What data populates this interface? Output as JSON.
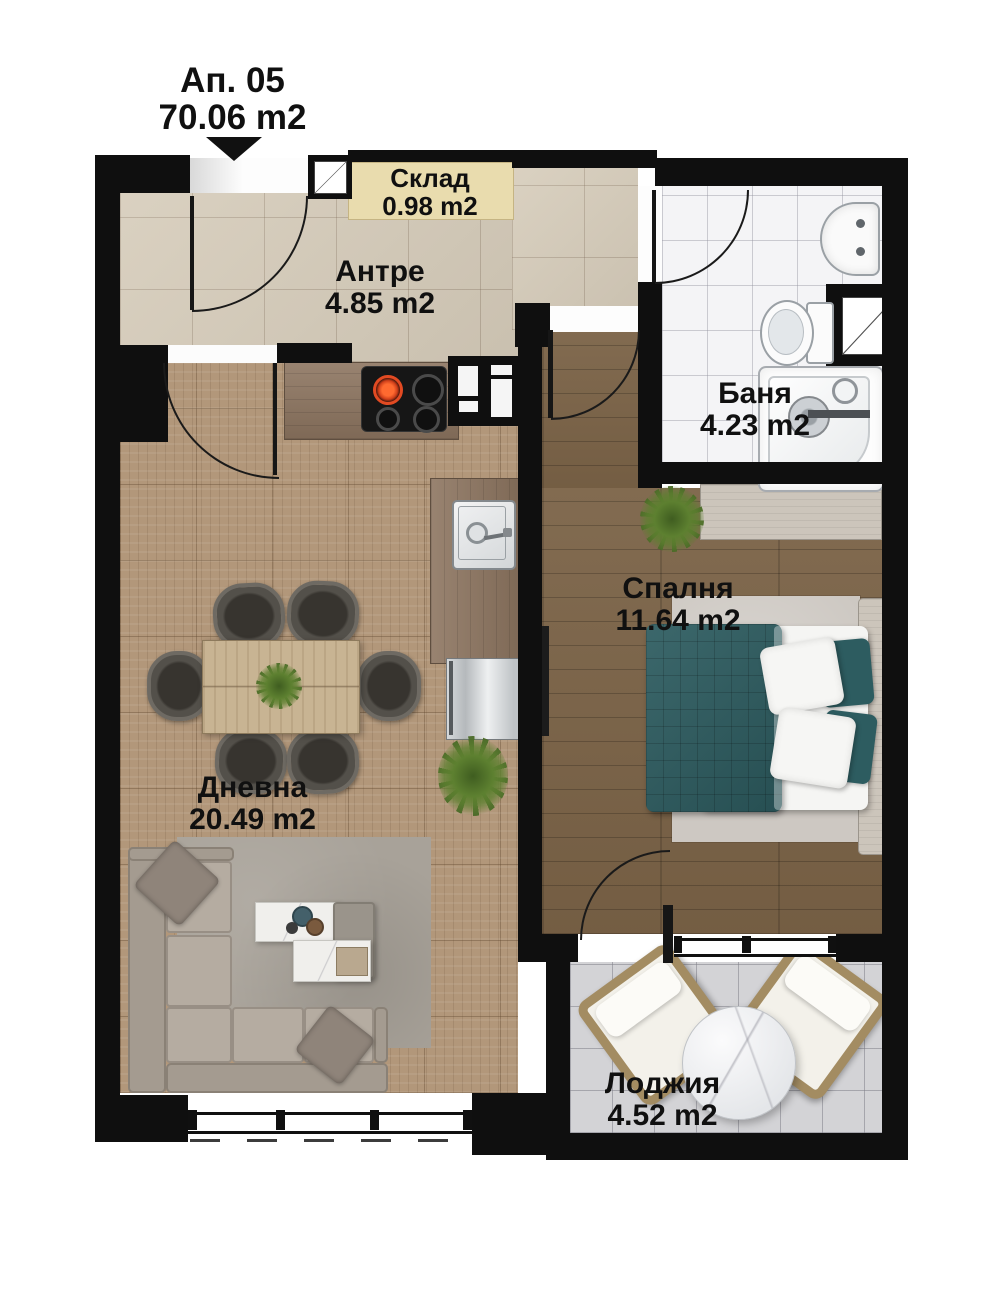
{
  "title": {
    "apartment_label": "Ап. 05",
    "total_area": "70.06 m2"
  },
  "rooms": [
    {
      "name": "Склад",
      "area": "0.98 m2"
    },
    {
      "name": "Антре",
      "area": "4.85 m2"
    },
    {
      "name": "Баня",
      "area": "4.23 m2"
    },
    {
      "name": "Спалня",
      "area": "11.64 m2"
    },
    {
      "name": "Дневна",
      "area": "20.49 m2"
    },
    {
      "name": "Лоджия",
      "area": "4.52 m2"
    }
  ],
  "colors": {
    "wall": "#0f0f0f",
    "antre_floor": "#d6ccba",
    "sklad_floor": "#e9dcae",
    "bath_floor": "#f4f4f6",
    "bedroom_floor": "#7b6347",
    "living_floor": "#b2977a",
    "loggia_floor": "#d3d3d6",
    "bed_accent": "#2d5c60",
    "label_text": "#101010"
  }
}
